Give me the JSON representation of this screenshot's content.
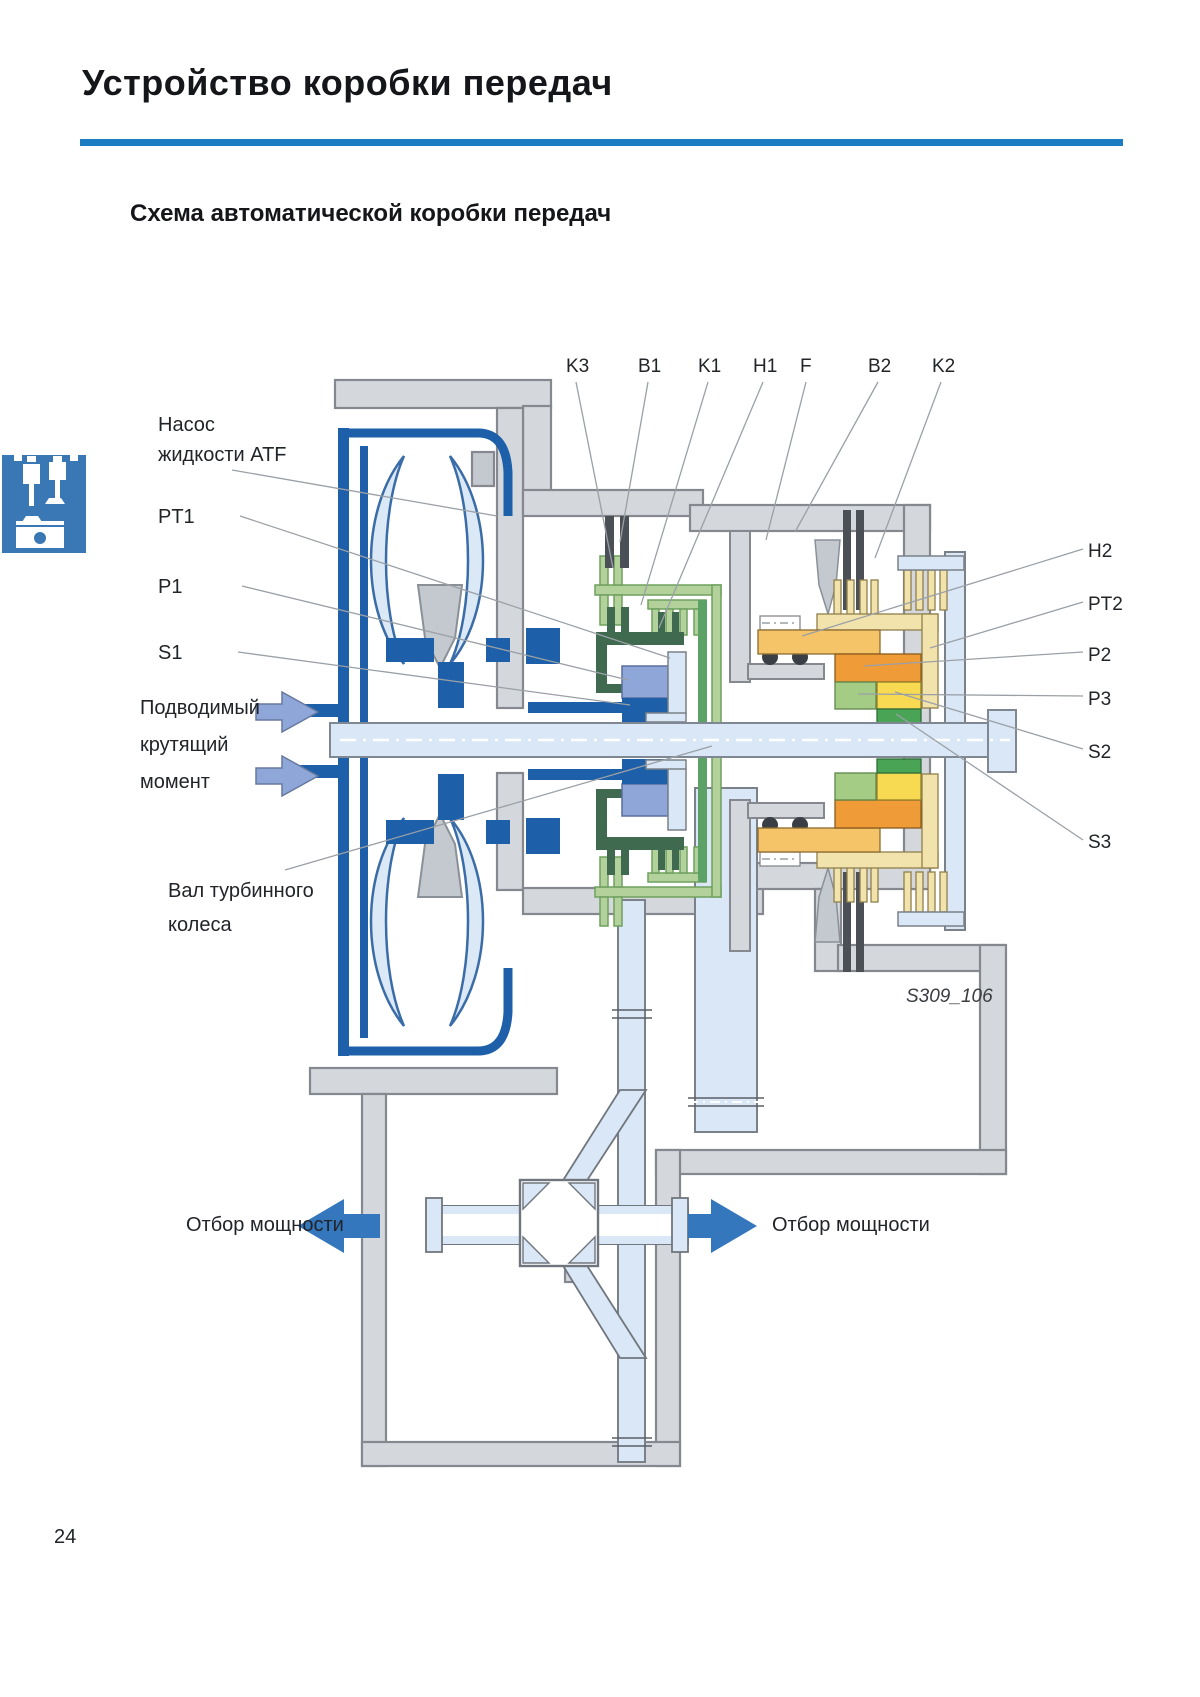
{
  "header": {
    "title": "Устройство коробки передач",
    "subtitle": "Схема автоматической коробки передач"
  },
  "figure": {
    "code": "S309_106"
  },
  "footer": {
    "page_number": "24"
  },
  "labels": {
    "top": [
      "K3",
      "B1",
      "K1",
      "H1",
      "F",
      "B2",
      "K2"
    ],
    "left": {
      "pump_line1": "Насос",
      "pump_line2": "жидкости ATF",
      "pt1": "PT1",
      "p1": "P1",
      "s1": "S1",
      "input_torque_line1": "Подводимый",
      "input_torque_line2": "крутящий",
      "input_torque_line3": "момент",
      "turbine_shaft_line1": "Вал турбинного",
      "turbine_shaft_line2": "колеса"
    },
    "right": [
      "H2",
      "PT2",
      "P2",
      "P3",
      "S2",
      "S3"
    ],
    "power_takeoff_left": "Отбор мощности",
    "power_takeoff_right": "Отбор мощности"
  },
  "colors": {
    "rule_blue": "#1c7dc2",
    "icon_blue": "#3a78b5",
    "housing_gray": "#d4d7db",
    "housing_stroke": "#85898f",
    "navy": "#1d5fa8",
    "light_blue": "#d9e7f6",
    "periwinkle": "#8fa6d8",
    "light_green": "#b3d19a",
    "medium_green": "#5ca266",
    "dark_green": "#3f6a50",
    "green": "#4aa455",
    "cream": "#f2e3ad",
    "amber": "#f6c468",
    "orange": "#ef9b38",
    "yellow": "#f7da52",
    "plate_gray": "#4b5057",
    "arrow_blue": "#3577bd"
  }
}
